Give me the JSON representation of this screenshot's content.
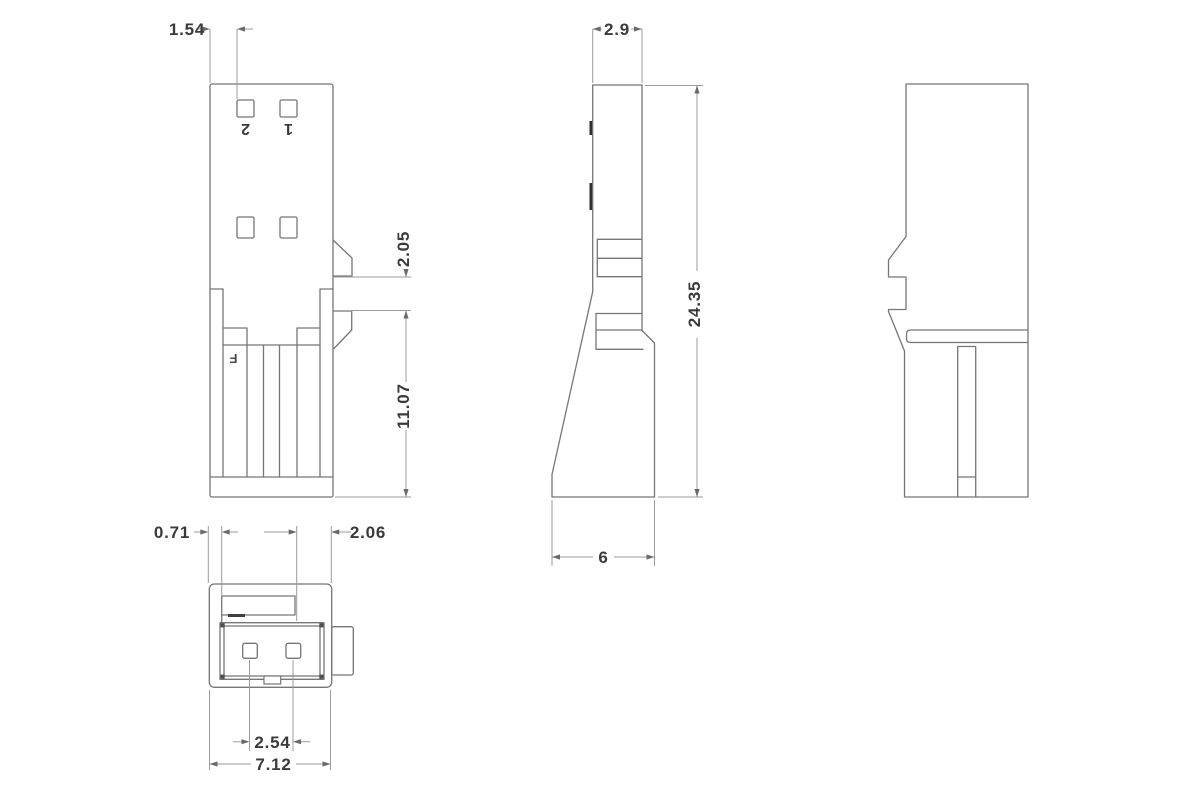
{
  "dims": {
    "front": {
      "pin_offset": "1.54",
      "latch_gap": "2.05",
      "lower_height": "11.07"
    },
    "side": {
      "top_width": "2.9",
      "overall_height": "24.35",
      "bottom_depth": "6"
    },
    "bottom": {
      "wall_offset": "0.71",
      "edge_offset": "2.06",
      "pin_pitch": "2.54",
      "overall_width": "7.12"
    }
  },
  "pin_labels": {
    "pin2": "2",
    "pin1": "1"
  },
  "marks": {
    "mold_mark": "F"
  },
  "colors": {
    "object_line": "#767676",
    "dimension_line": "#9b9b9b",
    "text": "#3a3a3a",
    "background": "#ffffff"
  }
}
